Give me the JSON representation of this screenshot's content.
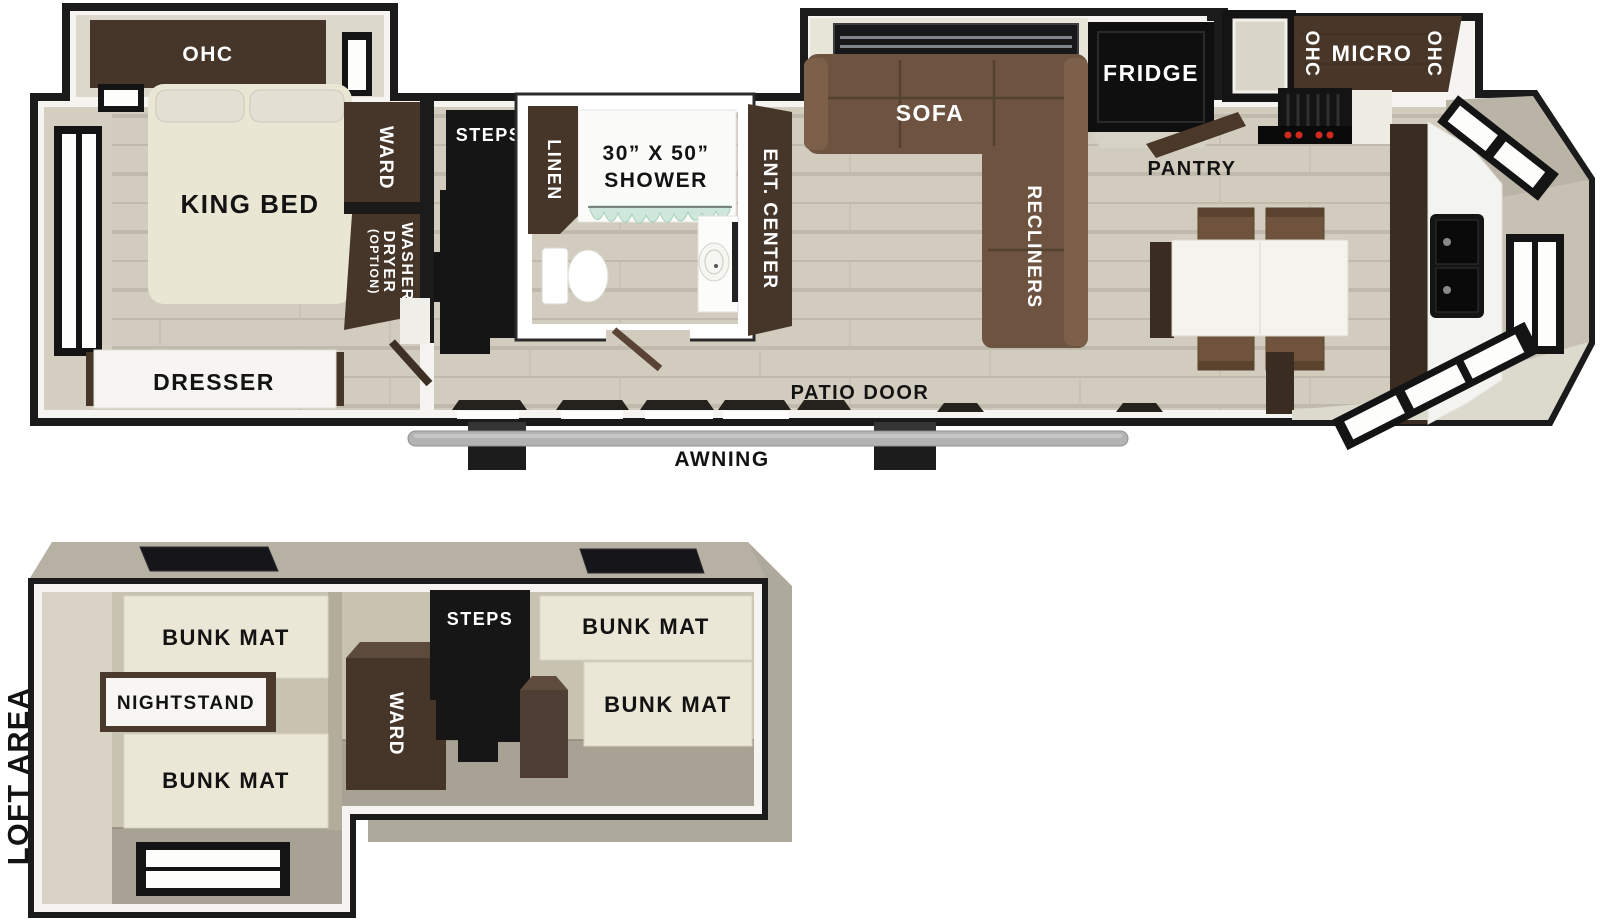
{
  "palette": {
    "wall": "#1b1b1b",
    "trim": "#f5f4f0",
    "cabinet": "#46362a",
    "cabinet_dark": "#3a2c21",
    "sofa": "#6d5340",
    "sofa_light": "#7c604a",
    "mattress": "#eae6d4",
    "bunk_mat": "#ebe7d6",
    "loft_wall": "#c8c2b1",
    "loft_floor": "#a7a294",
    "roof": "#b6b1a3",
    "awning": "#b3b3b3",
    "accent_red": "#d3281e",
    "curtain": "#cfe7db",
    "window_white": "#fdfdfc",
    "bay_band": "#b9b4a6",
    "floor": "#d1ccbd"
  },
  "main_floor": {
    "bedroom": {
      "ohc_label": "OHC",
      "king_bed_label": "KING BED",
      "ward_label": "WARD",
      "washer_line1": "WASHER",
      "washer_line2": "DRYER",
      "washer_line3": "(OPTION)",
      "dresser_label": "DRESSER"
    },
    "hall": {
      "steps_label": "STEPS"
    },
    "bathroom": {
      "linen_label": "LINEN",
      "shower_line1": "30” X 50”",
      "shower_line2": "SHOWER",
      "ent_center_label": "ENT. CENTER"
    },
    "living": {
      "sofa_label": "SOFA",
      "recliners_label": "RECLINERS",
      "fridge_label": "FRIDGE",
      "pantry_label": "PANTRY"
    },
    "kitchen": {
      "ohc_left_label": "OHC",
      "micro_label": "MICRO",
      "ohc_right_label": "OHC"
    },
    "exterior": {
      "patio_door_label": "PATIO DOOR",
      "awning_label": "AWNING"
    }
  },
  "loft": {
    "area_label": "LOFT AREA",
    "bunk_mat_top_left": "BUNK MAT",
    "nightstand_label": "NIGHTSTAND",
    "bunk_mat_bottom_left": "BUNK MAT",
    "ward_label": "WARD",
    "steps_label": "STEPS",
    "bunk_mat_top_right": "BUNK MAT",
    "bunk_mat_bottom_right": "BUNK MAT"
  }
}
